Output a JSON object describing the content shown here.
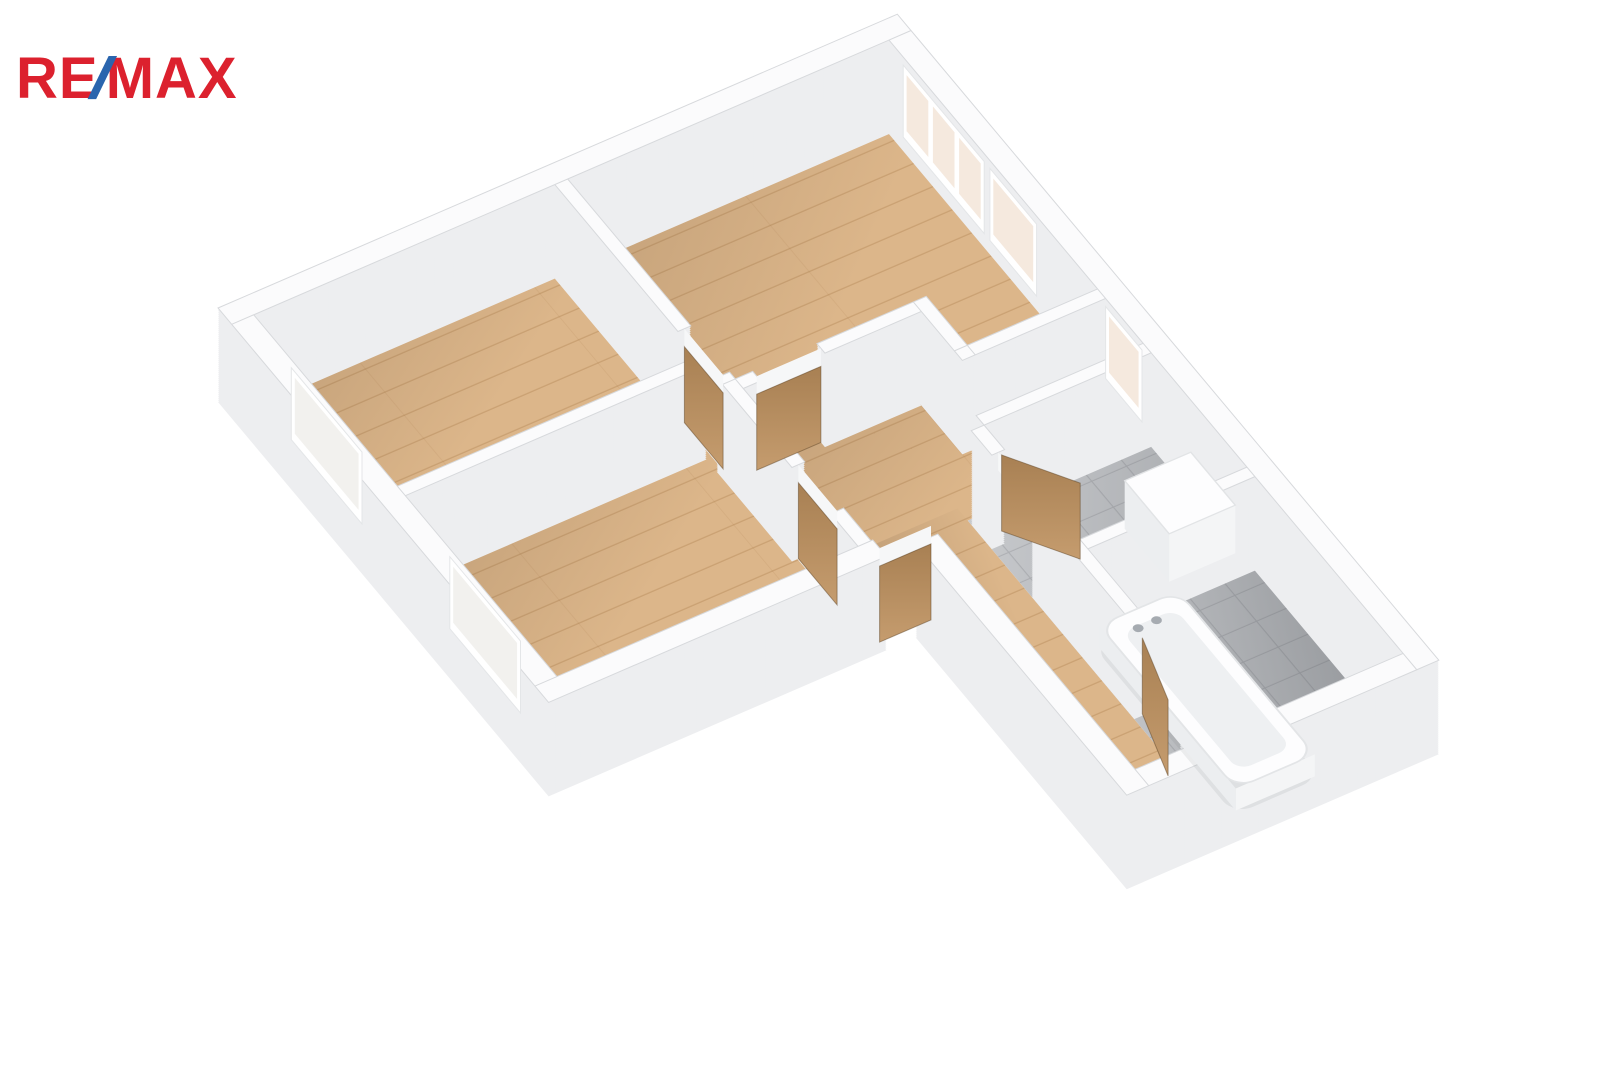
{
  "logo": {
    "re": "RE",
    "slash": "/",
    "max": "MAX",
    "color_red": "#DC212E",
    "color_blue": "#2A65AE"
  },
  "scene": {
    "description": "3D axonometric floor plan of an apartment with wooden floors, white walls, tiled WC and bathroom with bathtub",
    "projection": {
      "ux": 0.918,
      "uy": -0.397,
      "vx": 0.57,
      "vy": 0.68,
      "ox": 218,
      "oy": 402,
      "wall_height": 94,
      "step": 2,
      "door_height": 76
    },
    "palette": {
      "wall_body": "#edeef0",
      "wall_cap": "#fbfbfc",
      "wall_edge": "#d7d9dc",
      "wood": "#dcb68a",
      "wood_line": "rgba(146,99,49,0.25)",
      "tile": "#c8cacd",
      "tile_line": "rgba(75,80,88,0.18)",
      "glass": "#f5e9de",
      "glass_faint": "#f2f1ee",
      "frame": "#ffffff",
      "door_light": "#c59c6e",
      "door_dark": "#a88053",
      "door_edge": "rgba(96,70,40,0.5)",
      "lintel": "#f6f7f8",
      "fixture": "#fdfdfe",
      "fixture_side": "#eceef0",
      "fixture_side2": "#f4f5f6",
      "basin": "#eef0f2",
      "tap": "#a6abb1",
      "tub_shadow": "rgba(100,105,110,0.10)"
    },
    "wall_rects": [
      [
        0,
        0,
        740,
        24
      ],
      [
        716,
        24,
        24,
        926
      ],
      [
        424,
        926,
        292,
        24
      ],
      [
        400,
        580,
        24,
        370
      ],
      [
        0,
        556,
        368,
        24
      ],
      [
        0,
        24,
        24,
        532
      ],
      [
        352,
        24,
        14,
        216
      ],
      [
        352,
        308,
        14,
        10
      ],
      [
        24,
        276,
        328,
        14
      ],
      [
        352,
        318,
        14,
        122
      ],
      [
        352,
        508,
        14,
        48
      ],
      [
        366,
        318,
        19,
        14
      ],
      [
        455,
        318,
        105,
        14
      ],
      [
        560,
        318,
        14,
        86
      ],
      [
        560,
        390,
        156,
        14
      ],
      [
        534,
        470,
        182,
        14
      ],
      [
        520,
        484,
        14,
        36
      ],
      [
        520,
        590,
        14,
        62
      ],
      [
        534,
        652,
        182,
        14
      ],
      [
        520,
        652,
        14,
        118
      ],
      [
        520,
        850,
        14,
        76
      ]
    ],
    "floors": [
      {
        "name": "bedroom-a",
        "type": "wood",
        "path": [
          [
            18,
            18
          ],
          [
            358,
            18
          ],
          [
            358,
            282
          ],
          [
            18,
            282
          ]
        ]
      },
      {
        "name": "bedroom-b",
        "type": "wood",
        "path": [
          [
            18,
            282
          ],
          [
            358,
            282
          ],
          [
            358,
            562
          ],
          [
            18,
            562
          ]
        ]
      },
      {
        "name": "living-room",
        "type": "wood",
        "path": [
          [
            360,
            18
          ],
          [
            722,
            18
          ],
          [
            722,
            396
          ],
          [
            566,
            396
          ],
          [
            566,
            324
          ],
          [
            360,
            324
          ]
        ]
      },
      {
        "name": "hallway",
        "type": "wood",
        "path": [
          [
            360,
            318
          ],
          [
            566,
            318
          ],
          [
            566,
            398
          ],
          [
            722,
            398
          ],
          [
            722,
            478
          ],
          [
            430,
            478
          ],
          [
            430,
            562
          ],
          [
            360,
            562
          ]
        ]
      },
      {
        "name": "corridor",
        "type": "wood",
        "path": [
          [
            424,
            460
          ],
          [
            520,
            460
          ],
          [
            520,
            930
          ],
          [
            424,
            930
          ]
        ]
      },
      {
        "name": "wc",
        "type": "tile_wc",
        "path": [
          [
            520,
            478
          ],
          [
            722,
            478
          ],
          [
            722,
            658
          ],
          [
            520,
            658
          ]
        ]
      },
      {
        "name": "bathroom",
        "type": "tile_bath",
        "path": [
          [
            520,
            652
          ],
          [
            722,
            652
          ],
          [
            722,
            932
          ],
          [
            520,
            932
          ]
        ]
      }
    ],
    "windows": [
      {
        "name": "window-living-triple",
        "from": [
          716,
          49
        ],
        "to": [
          716,
          191
        ],
        "panes": [
          [
            55,
            93
          ],
          [
            101,
            139
          ],
          [
            147,
            185
          ]
        ],
        "glass": "glass"
      },
      {
        "name": "window-living-single",
        "from": [
          716,
          201
        ],
        "to": [
          716,
          283
        ],
        "panes": [
          [
            207,
            277
          ]
        ],
        "glass": "glass"
      },
      {
        "name": "window-hallway",
        "from": [
          716,
          404
        ],
        "to": [
          716,
          468
        ],
        "panes": [
          [
            410,
            462
          ]
        ],
        "glass": "glass"
      },
      {
        "name": "window-bedroom-a-west",
        "from": [
          24,
          90
        ],
        "to": [
          24,
          214
        ],
        "panes": [
          [
            96,
            208
          ]
        ],
        "glass": "glass_faint"
      },
      {
        "name": "window-bedroom-b-west",
        "from": [
          24,
          368
        ],
        "to": [
          24,
          492
        ],
        "panes": [
          [
            374,
            486
          ]
        ],
        "glass": "glass_faint"
      }
    ],
    "window_metrics": {
      "frame_h": [
        14,
        86
      ],
      "glass_h": [
        24,
        80
      ]
    },
    "doors": [
      {
        "name": "door-bedroom-a",
        "from": [
          359,
          240
        ],
        "to": [
          359,
          308
        ],
        "open": false
      },
      {
        "name": "door-living-room",
        "from": [
          385,
          325
        ],
        "to": [
          455,
          325
        ],
        "open": false
      },
      {
        "name": "door-bedroom-b",
        "from": [
          359,
          440
        ],
        "to": [
          359,
          508
        ],
        "open": false
      },
      {
        "name": "door-entry",
        "from": [
          368,
          568
        ],
        "to": [
          424,
          568
        ],
        "open": false
      },
      {
        "name": "door-wc-open",
        "from": [
          540,
          505
        ],
        "to": [
          584,
          572
        ],
        "open": true
      },
      {
        "name": "door-bathroom-open",
        "from": [
          530,
          768
        ],
        "to": [
          509,
          847
        ],
        "open": true
      }
    ],
    "extra_lintels": [
      {
        "from": [
          527,
          520
        ],
        "to": [
          527,
          590
        ]
      },
      {
        "from": [
          527,
          770
        ],
        "to": [
          527,
          850
        ]
      }
    ],
    "bathtub": {
      "shadow": [
        536,
        672,
        94,
        248
      ],
      "body": [
        540,
        676,
        86,
        240
      ],
      "basin": [
        554,
        694,
        58,
        204
      ],
      "lift": 22,
      "taps": [
        [
          564,
          706
        ],
        [
          584,
          706
        ]
      ],
      "tap_lift": 30
    },
    "washer": {
      "rect": [
        640,
        560,
        72,
        78
      ],
      "lift": 48
    }
  }
}
